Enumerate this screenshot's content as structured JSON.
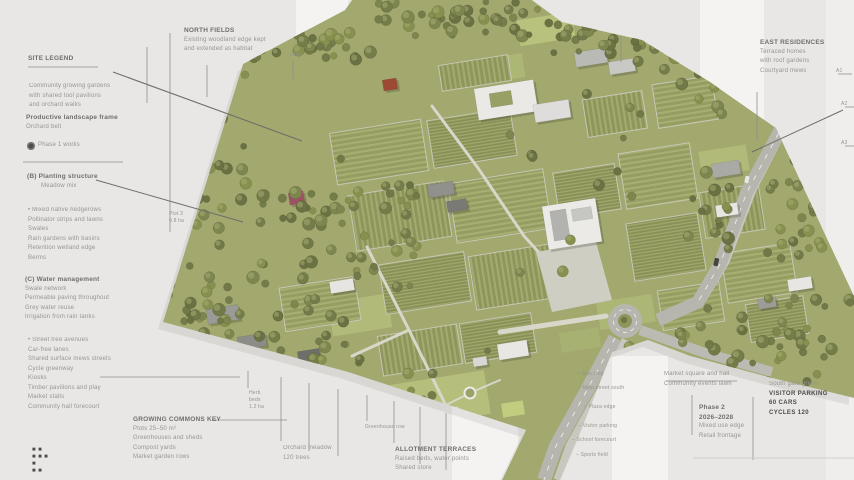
{
  "colors": {
    "canvas": "#e8e7e5",
    "plan_green": "#a2a86e",
    "tree_palette": [
      "#6a7143",
      "#747c4a",
      "#7e8650",
      "#87904f",
      "#717948"
    ],
    "tree_highlight": "#a9b074",
    "road": "#b7b6ae",
    "roof_white": "#ebeae6",
    "accent_red": "#9c4a33",
    "accent_maroon": "#9d5365",
    "leader_line": "#8f8f8b",
    "leader_dark": "#6e6e6a",
    "label_text": "#95958f"
  },
  "annotations": {
    "labels": [
      {
        "id": "left-legend-title",
        "x": 28,
        "y": 54,
        "rows": [
          {
            "t": "SITE LEGEND",
            "b": 1
          }
        ]
      },
      {
        "id": "left-note-1",
        "x": 29,
        "y": 82,
        "rows": [
          "Community growing gardens",
          "with shared tool pavilions",
          "and orchard walks"
        ]
      },
      {
        "id": "left-note-2",
        "x": 26,
        "y": 113,
        "rows": [
          {
            "t": "Productive landscape frame",
            "b": 1
          },
          "Orchard belt"
        ]
      },
      {
        "id": "phase-legend",
        "x": 27,
        "y": 141,
        "icon": "phase-dot",
        "rows": [
          "Phase 1 works"
        ]
      },
      {
        "id": "left-section-b",
        "x": 27,
        "y": 172,
        "rows": [
          {
            "t": "(B) Planting structure",
            "b": 1
          },
          {
            "t": "Meadow mix",
            "ind": 14
          }
        ]
      },
      {
        "id": "left-list-1",
        "x": 28,
        "y": 206,
        "rows": [
          "• Mixed native hedgerows",
          "Pollinator strips and lawns",
          "Swales",
          "Rain gardens with basins",
          "Retention wetland edge",
          "Berms"
        ]
      },
      {
        "id": "left-section-c",
        "x": 25,
        "y": 275,
        "rows": [
          {
            "t": "(C) Water management",
            "b": 1
          },
          "Swale network",
          "Permeable paving throughout",
          "Grey water reuse",
          "Irrigation from rain tanks"
        ]
      },
      {
        "id": "left-list-2",
        "x": 28,
        "y": 336,
        "rows": [
          "• Street tree avenues",
          "Car-free lanes",
          "Shared surface mews streets",
          "Cycle greenway",
          "Kiosks",
          "Timber pavilions and play",
          "Market stalls",
          "Community hall forecourt"
        ]
      },
      {
        "id": "footer-marks",
        "x": 32,
        "y": 447,
        "size": "s",
        "rows": [
          {
            "t": "■ ■",
            "dark": 1
          },
          {
            "t": "■ ■ ■",
            "dark": 1
          },
          {
            "t": "■",
            "dark": 1
          },
          {
            "t": "■ ■",
            "dark": 1
          }
        ]
      },
      {
        "id": "growing-key",
        "x": 133,
        "y": 415,
        "rows": [
          {
            "t": "GROWING COMMONS KEY",
            "b": 1
          },
          "Plots 25–50 m²",
          "Greenhouses and sheds",
          "Compost yards",
          "Market garden rows"
        ]
      },
      {
        "id": "plot-tag",
        "x": 169,
        "y": 211,
        "size": "s",
        "rows": [
          "Plot 3",
          "0.8 ha"
        ]
      },
      {
        "id": "north-label",
        "x": 184,
        "y": 26,
        "rows": [
          {
            "t": "NORTH FIELDS",
            "b": 1
          },
          "Existing woodland edge kept",
          "and extended as habitat"
        ]
      },
      {
        "id": "oak-tag",
        "x": 290,
        "y": 52,
        "size": "s",
        "rows": [
          "Oaks"
        ]
      },
      {
        "id": "east-label",
        "x": 760,
        "y": 38,
        "rows": [
          {
            "t": "EAST RESIDENCES",
            "b": 1
          },
          "Terraced homes",
          "with roof gardens",
          "Courtyard mews"
        ]
      },
      {
        "id": "edge-tag-1",
        "x": 836,
        "y": 68,
        "size": "s",
        "rows": [
          "A1"
        ]
      },
      {
        "id": "edge-tag-2",
        "x": 841,
        "y": 101,
        "size": "s",
        "rows": [
          "A2"
        ]
      },
      {
        "id": "edge-tag-3",
        "x": 841,
        "y": 140,
        "size": "s",
        "rows": [
          "A3"
        ]
      },
      {
        "id": "road-note-1",
        "x": 578,
        "y": 371,
        "size": "s",
        "rows": [
          "– Bus stop"
        ]
      },
      {
        "id": "road-note-2",
        "x": 578,
        "y": 385,
        "size": "s",
        "rows": [
          "– Main street south"
        ]
      },
      {
        "id": "road-note-3",
        "x": 584,
        "y": 404,
        "size": "s",
        "rows": [
          "– Plaza edge"
        ]
      },
      {
        "id": "road-note-4",
        "x": 578,
        "y": 423,
        "size": "s",
        "rows": [
          "– Visitor parking"
        ]
      },
      {
        "id": "road-note-5",
        "x": 572,
        "y": 437,
        "size": "s",
        "rows": [
          "– School forecourt"
        ]
      },
      {
        "id": "road-note-6",
        "x": 576,
        "y": 452,
        "size": "s",
        "rows": [
          "– Sports field"
        ]
      },
      {
        "id": "herb-tag",
        "x": 249,
        "y": 390,
        "size": "s",
        "rows": [
          "Herb",
          "beds",
          "1.2 ha"
        ]
      },
      {
        "id": "orchard-note",
        "x": 283,
        "y": 444,
        "rows": [
          "Orchard meadow",
          "120 trees"
        ]
      },
      {
        "id": "greenhouse-tag",
        "x": 365,
        "y": 424,
        "size": "s",
        "rows": [
          "Greenhouse row"
        ]
      },
      {
        "id": "allotment-note",
        "x": 395,
        "y": 445,
        "rows": [
          {
            "t": "ALLOTMENT TERRACES",
            "b": 1
          },
          "Raised beds, water points",
          "Shared store"
        ]
      },
      {
        "id": "market-note",
        "x": 664,
        "y": 370,
        "rows": [
          "Market square and hall",
          "Community events lawn"
        ]
      },
      {
        "id": "phase2-note",
        "x": 699,
        "y": 403,
        "rows": [
          {
            "t": "Phase 2",
            "b": 1
          },
          {
            "t": "2026–2028",
            "b": 1
          },
          "Mixed use edge",
          "Retail frontage"
        ]
      },
      {
        "id": "parking-note",
        "x": 769,
        "y": 380,
        "rows": [
          "South gate green",
          {
            "t": "VISITOR PARKING",
            "dark": 1
          },
          {
            "t": "60 CARS",
            "dark": 1
          },
          {
            "t": "CYCLES 120",
            "dark": 1
          }
        ]
      }
    ],
    "lines": [
      {
        "x1": 28,
        "y1": 67,
        "x2": 98,
        "y2": 67
      },
      {
        "x1": 23,
        "y1": 162,
        "x2": 123,
        "y2": 162
      },
      {
        "x1": 170,
        "y1": 33,
        "x2": 170,
        "y2": 232
      },
      {
        "x1": 147,
        "y1": 47,
        "x2": 147,
        "y2": 103
      },
      {
        "x1": 113,
        "y1": 72,
        "x2": 302,
        "y2": 141,
        "c": "#6e6e6a",
        "w": 1.1
      },
      {
        "x1": 96,
        "y1": 180,
        "x2": 243,
        "y2": 222,
        "c": "#6e6e6a",
        "w": 1
      },
      {
        "x1": 207,
        "y1": 65,
        "x2": 207,
        "y2": 97
      },
      {
        "x1": 293,
        "y1": 61,
        "x2": 293,
        "y2": 79
      },
      {
        "x1": 621,
        "y1": 36,
        "x2": 621,
        "y2": 62
      },
      {
        "x1": 757,
        "y1": 92,
        "x2": 757,
        "y2": 140
      },
      {
        "x1": 843,
        "y1": 110,
        "x2": 752,
        "y2": 152,
        "c": "#6e6e6a",
        "w": 1
      },
      {
        "x1": 838,
        "y1": 74,
        "x2": 852,
        "y2": 74
      },
      {
        "x1": 845,
        "y1": 107,
        "x2": 854,
        "y2": 107
      },
      {
        "x1": 845,
        "y1": 146,
        "x2": 854,
        "y2": 146
      },
      {
        "x1": 100,
        "y1": 377,
        "x2": 240,
        "y2": 377
      },
      {
        "x1": 212,
        "y1": 420,
        "x2": 287,
        "y2": 420
      },
      {
        "x1": 248,
        "y1": 371,
        "x2": 248,
        "y2": 388
      },
      {
        "x1": 281,
        "y1": 377,
        "x2": 281,
        "y2": 441
      },
      {
        "x1": 309,
        "y1": 383,
        "x2": 309,
        "y2": 451
      },
      {
        "x1": 338,
        "y1": 389,
        "x2": 338,
        "y2": 456
      },
      {
        "x1": 367,
        "y1": 395,
        "x2": 367,
        "y2": 421
      },
      {
        "x1": 394,
        "y1": 401,
        "x2": 394,
        "y2": 443
      },
      {
        "x1": 420,
        "y1": 407,
        "x2": 420,
        "y2": 464
      },
      {
        "x1": 446,
        "y1": 413,
        "x2": 446,
        "y2": 470
      },
      {
        "x1": 692,
        "y1": 395,
        "x2": 692,
        "y2": 435
      },
      {
        "x1": 753,
        "y1": 397,
        "x2": 753,
        "y2": 460
      },
      {
        "x1": 666,
        "y1": 381,
        "x2": 737,
        "y2": 381
      },
      {
        "x1": 693,
        "y1": 458,
        "x2": 854,
        "y2": 458,
        "c": "#c6c6c2"
      }
    ]
  }
}
